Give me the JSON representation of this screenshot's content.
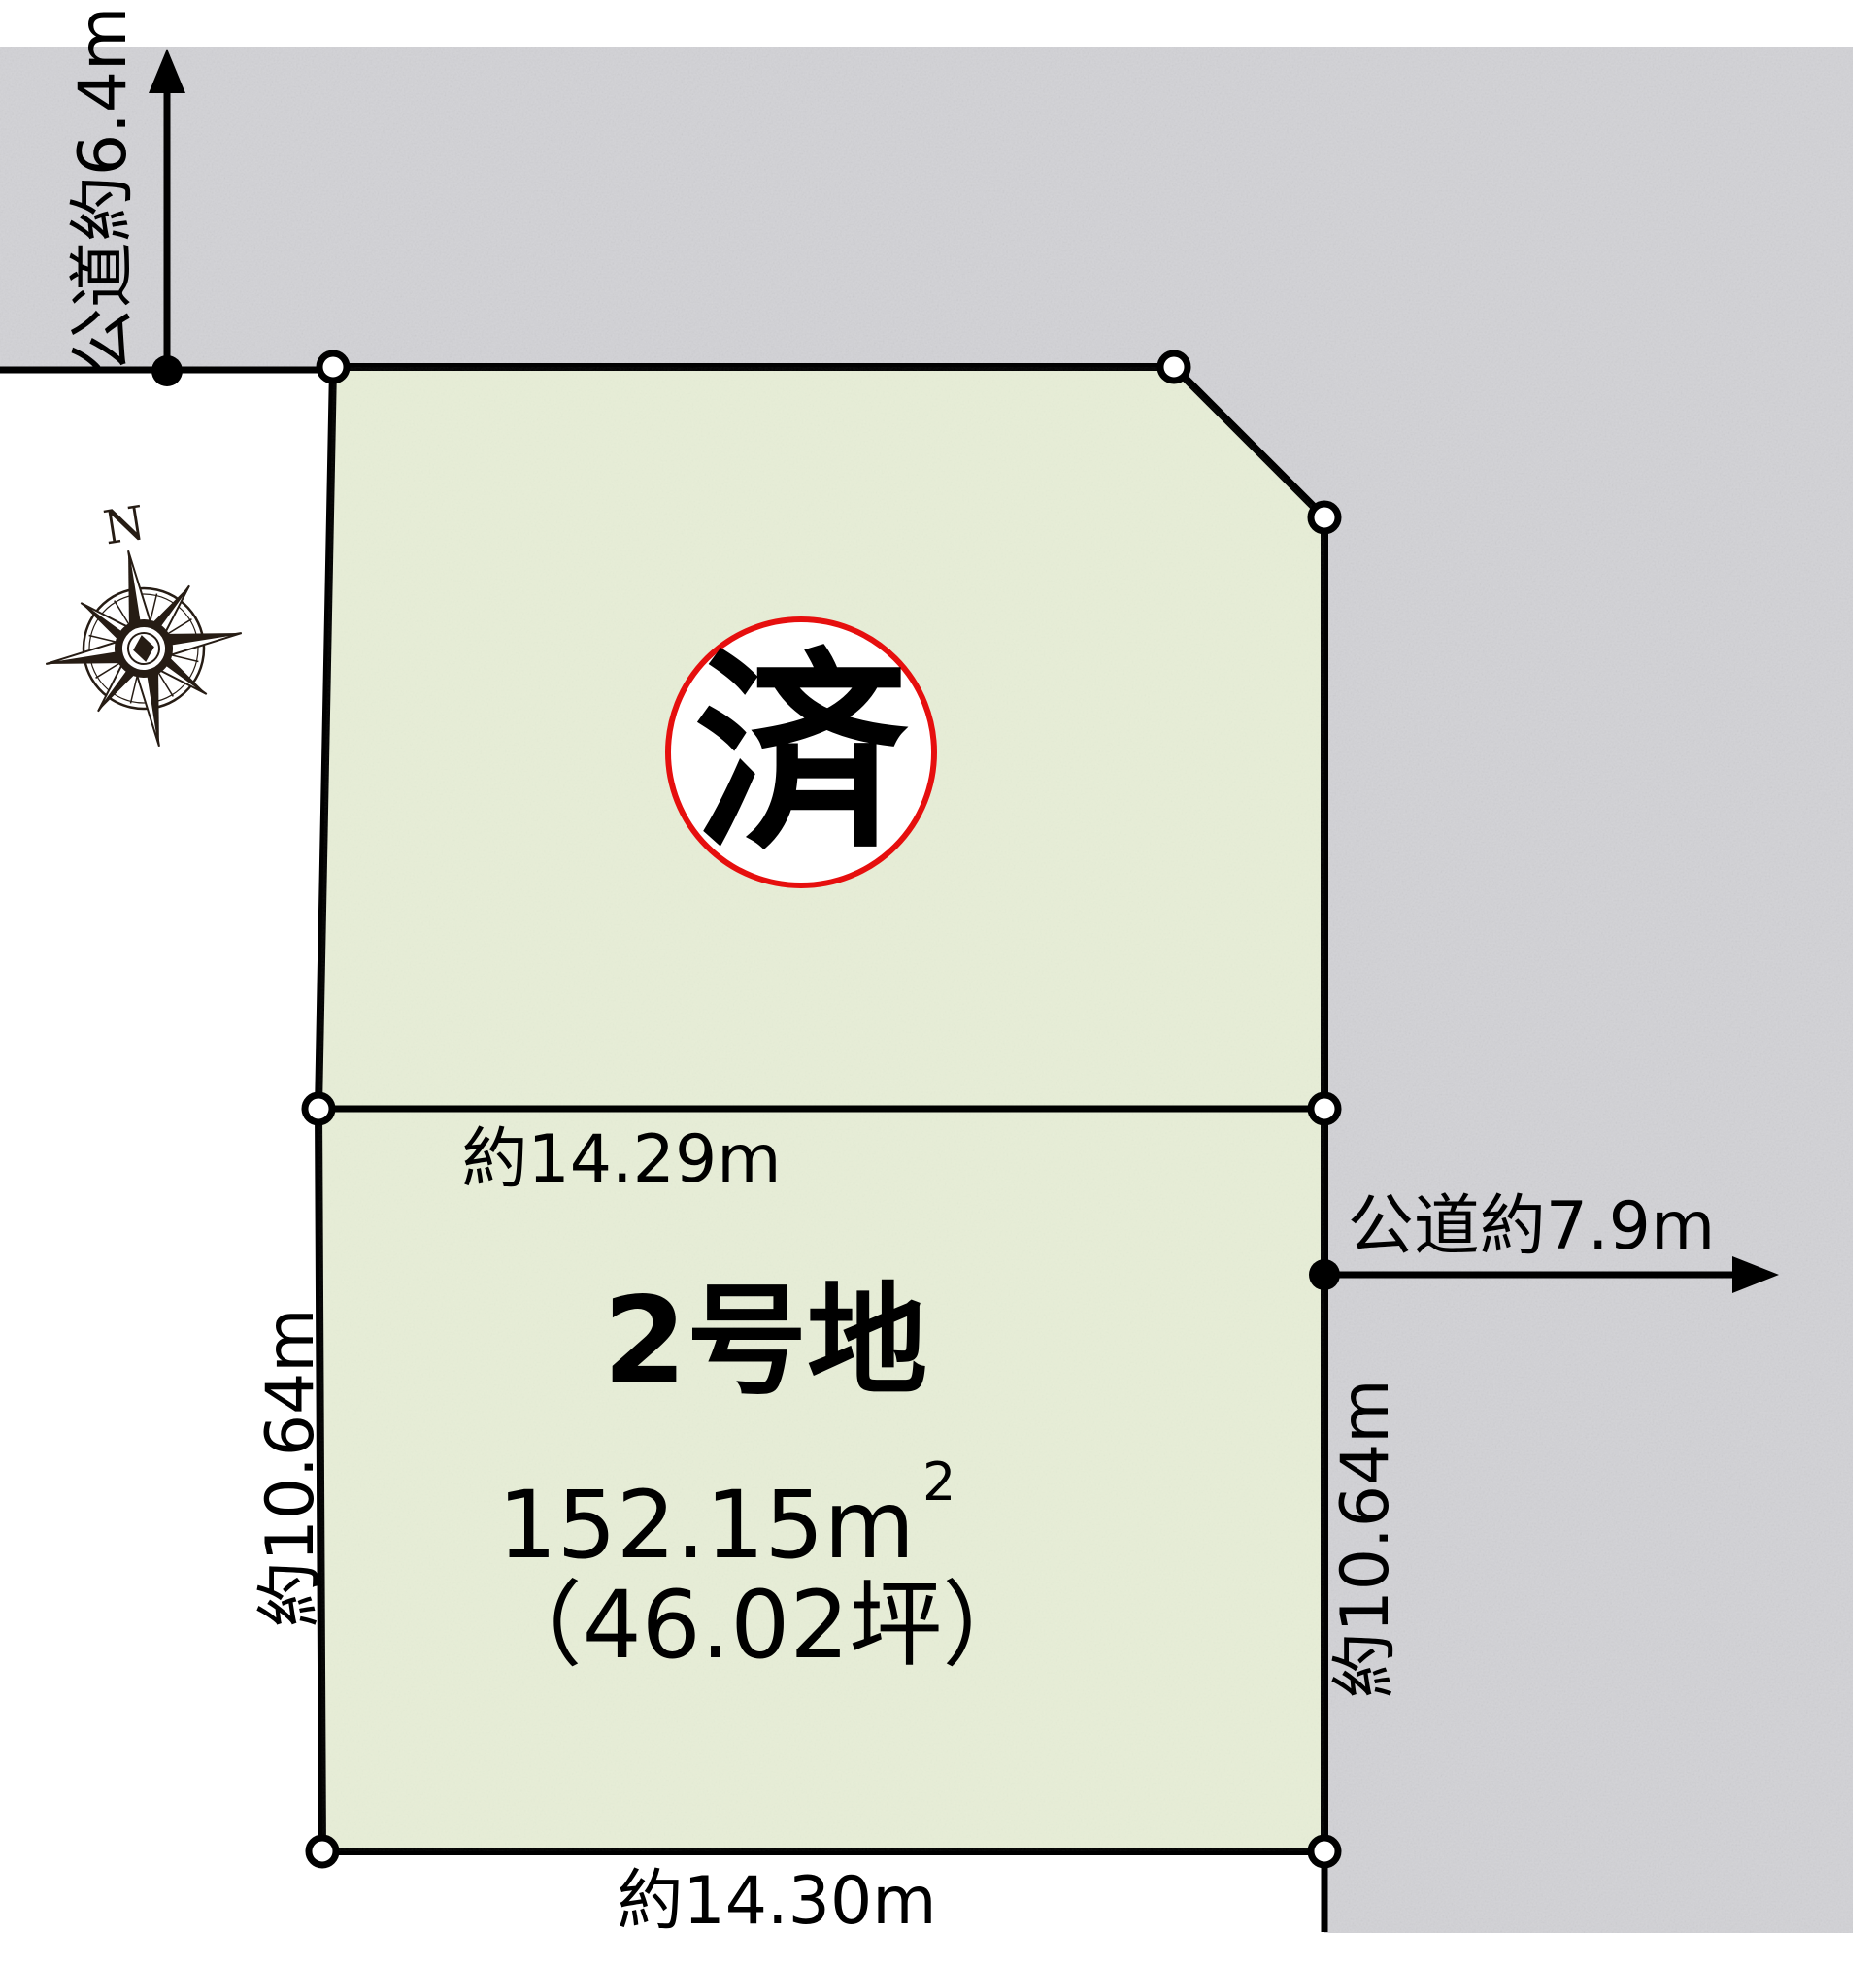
{
  "colors": {
    "plot_fill": "#e7eed7",
    "road_fill": "#d2d2d6",
    "line": "#000000",
    "stamp_red": "#e60f0e",
    "compass_ink": "#261c14"
  },
  "roads": {
    "top": {
      "label": "公道約6.4m"
    },
    "right": {
      "label": "公道約7.9m"
    }
  },
  "lot": {
    "name": "2号地",
    "area_main": "152.15m",
    "area_sup": "2",
    "area_tsubo": "（46.02坪）",
    "stamp": "済"
  },
  "dimensions": {
    "top": "約14.29m",
    "bottom": "約14.30m",
    "left": "約10.64m",
    "right": "約10.64m"
  },
  "compass": {
    "north": "N"
  }
}
